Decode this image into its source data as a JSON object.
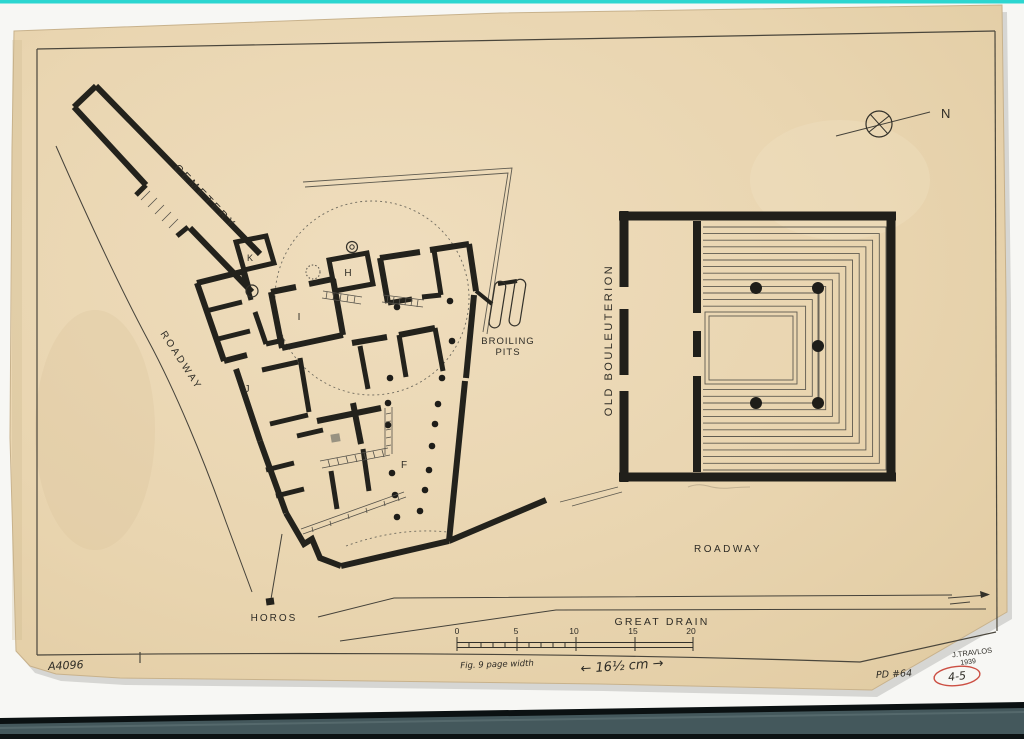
{
  "plan": {
    "labels": {
      "cemetery": "CEMETERY",
      "roadway_west": "ROADWAY",
      "roadway_south": "ROADWAY",
      "broiling_pits_line1": "BROILING",
      "broiling_pits_line2": "PITS",
      "old_bouleuterion": "OLD BOULEUTERION",
      "great_drain": "GREAT DRAIN",
      "horos": "HOROS",
      "north": "N"
    },
    "rooms": {
      "k": "K",
      "h": "H",
      "i": "I",
      "j": "J",
      "f": "F"
    },
    "scale_bar": {
      "ticks": [
        "0",
        "5",
        "10",
        "15",
        "20"
      ]
    }
  },
  "annotations": {
    "negative_number": "A4096",
    "author": "J.TRAVLOS",
    "year": "1939",
    "plate_number": "PD #64",
    "red_circle_note": "4-5",
    "pencil_note": "Fig. 9   page width",
    "pencil_measurement": "←  16½ cm  →"
  },
  "colors": {
    "paper": "#e9d6b2",
    "ink": "#23221c",
    "scanner_cyan": "#2cd6d0",
    "scanner_band": "#44585c",
    "red_note": "#cc4f43",
    "background": "#f7f7f4"
  }
}
